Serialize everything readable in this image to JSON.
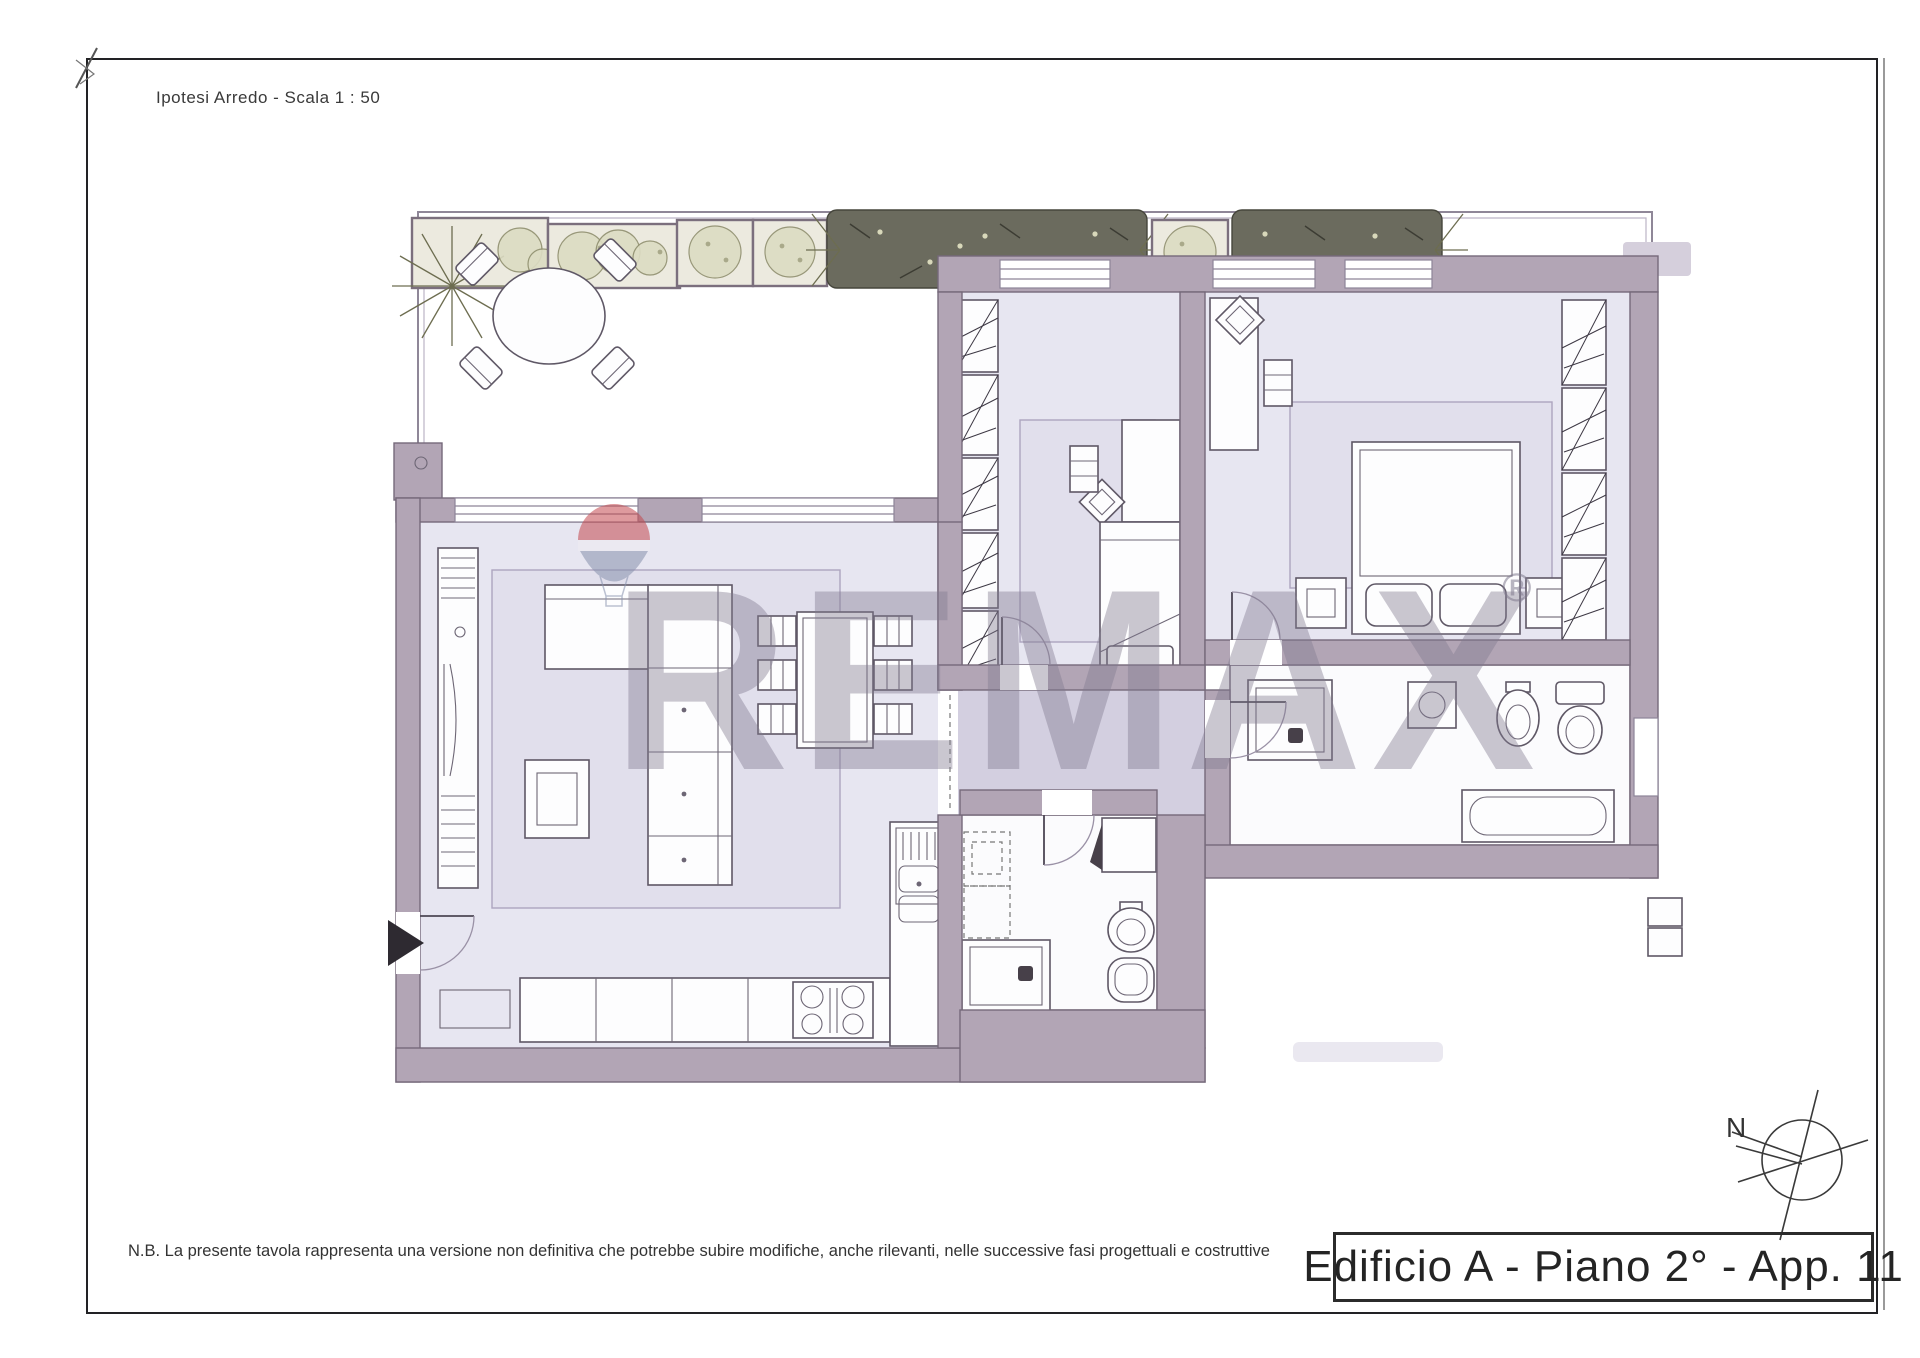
{
  "document": {
    "scale_label": "Ipotesi Arredo - Scala 1 : 50",
    "disclaimer": "N.B. La presente tavola rappresenta una versione non definitiva che potrebbe subire modifiche, anche rilevanti, nelle successive fasi progettuali e costruttive",
    "title_block": "Edificio A - Piano 2° - App. 11",
    "compass": {
      "north_label": "N"
    },
    "watermark": {
      "brand": "REMAX",
      "registered_mark": "®"
    }
  },
  "floor_plan": {
    "colors": {
      "wall": "#b2a5b5",
      "wall_outline": "#75697a",
      "room_floor": "#e7e6f1",
      "corridor_floor": "#d3cfe0",
      "bath_floor": "#fbfbfd",
      "plan_line": "#4d4754",
      "plant_soft": "#dcdcc3",
      "plant_dark": "#6b6b5e",
      "watermark_gray": "#807a90",
      "balloon_red": "#c4494f",
      "balloon_blue": "#8791ad"
    },
    "rooms": [
      {
        "name": "terrace",
        "features": [
          "planter-boxes",
          "hedges",
          "round-table",
          "four-chairs"
        ]
      },
      {
        "name": "living-room",
        "features": [
          "l-shaped-sofa",
          "coffee-table",
          "rug",
          "dining-table",
          "six-chairs",
          "tv-unit",
          "doormat"
        ]
      },
      {
        "name": "kitchen",
        "features": [
          "counter",
          "hob",
          "double-sink",
          "base-units"
        ]
      },
      {
        "name": "bedroom-1",
        "features": [
          "single-bed",
          "desk",
          "chairs",
          "hatched-wardrobe",
          "rug"
        ]
      },
      {
        "name": "master-bedroom",
        "features": [
          "double-bed",
          "nightstands",
          "desk",
          "chairs",
          "hatched-wardrobe",
          "rug"
        ]
      },
      {
        "name": "bathroom-1",
        "features": [
          "shower",
          "toilet",
          "bidet",
          "washing-machine",
          "vanity",
          "radiator"
        ]
      },
      {
        "name": "bathroom-2",
        "features": [
          "shower",
          "vanity-sink",
          "bidet",
          "toilet",
          "bathtub"
        ]
      },
      {
        "name": "corridor",
        "features": [
          "openings"
        ]
      }
    ],
    "entrance_marker": "black-triangle-left-wall",
    "north_direction": "upper-left"
  }
}
